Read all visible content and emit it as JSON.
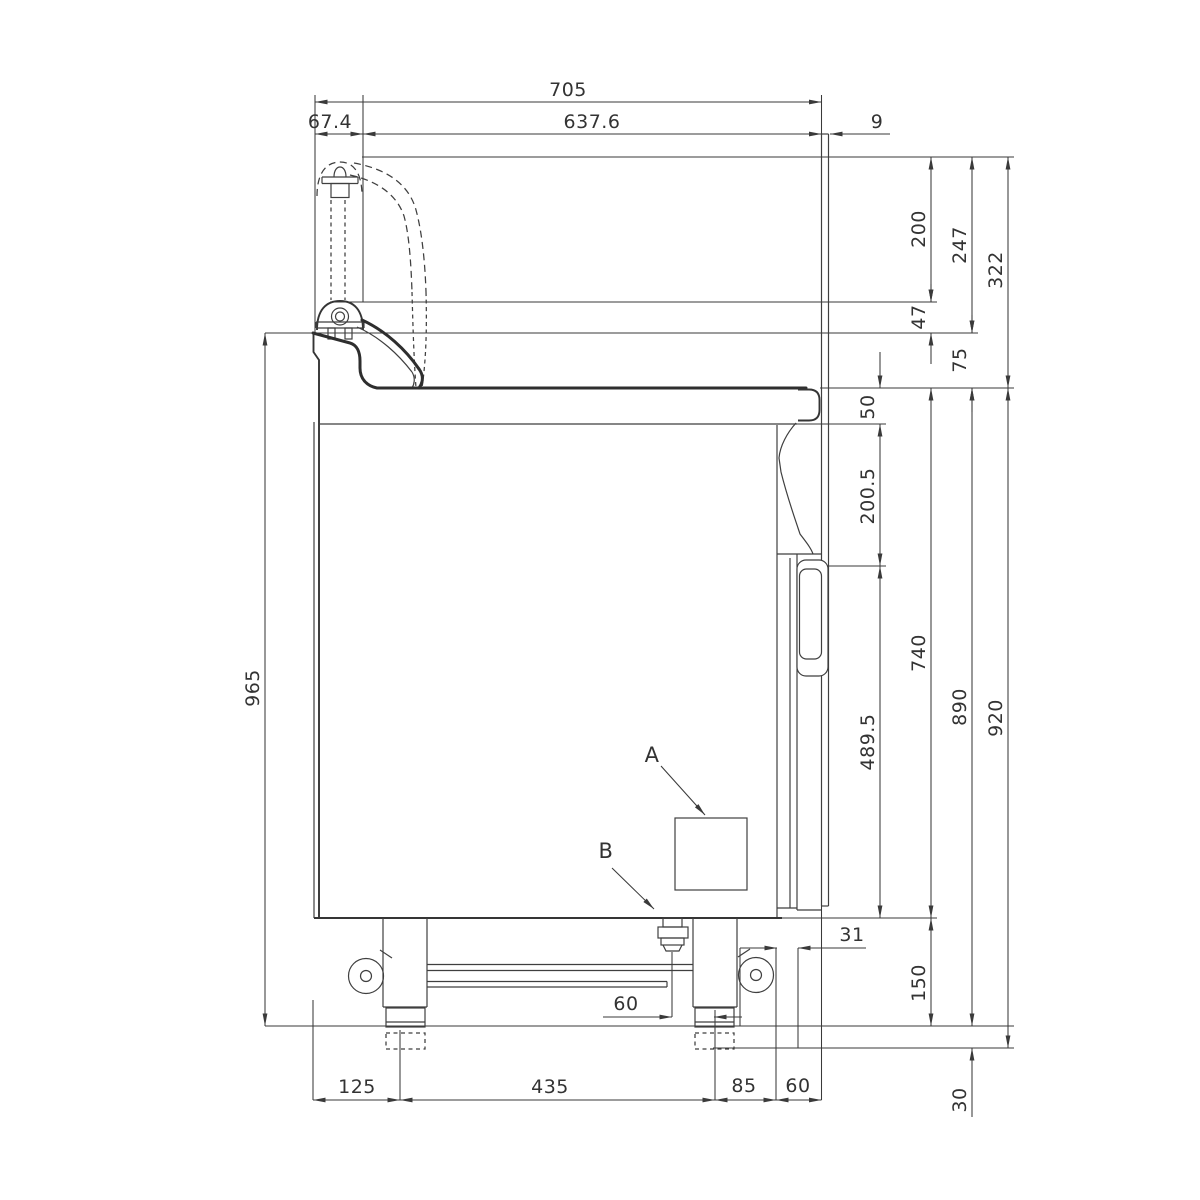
{
  "drawing": {
    "kind": "technical side elevation with dimensions",
    "units": "mm"
  },
  "dims": {
    "top": {
      "overall": "705",
      "left_offset": "67.4",
      "body": "637.6",
      "panel": "9"
    },
    "right": {
      "h200": "200",
      "h247": "247",
      "h322": "322",
      "h47": "47",
      "h75": "75",
      "h50": "50",
      "h200_5": "200.5",
      "h740": "740",
      "h489_5": "489.5",
      "h890": "890",
      "h920": "920",
      "h150": "150",
      "h30": "30",
      "h31": "31"
    },
    "left": {
      "total_height": "965"
    },
    "bottom": {
      "front_offset": "125",
      "leg_span": "435",
      "rear_offset": "85",
      "back_offset": "60",
      "foot_center": "60"
    }
  },
  "callouts": {
    "a": "A",
    "b": "B"
  }
}
